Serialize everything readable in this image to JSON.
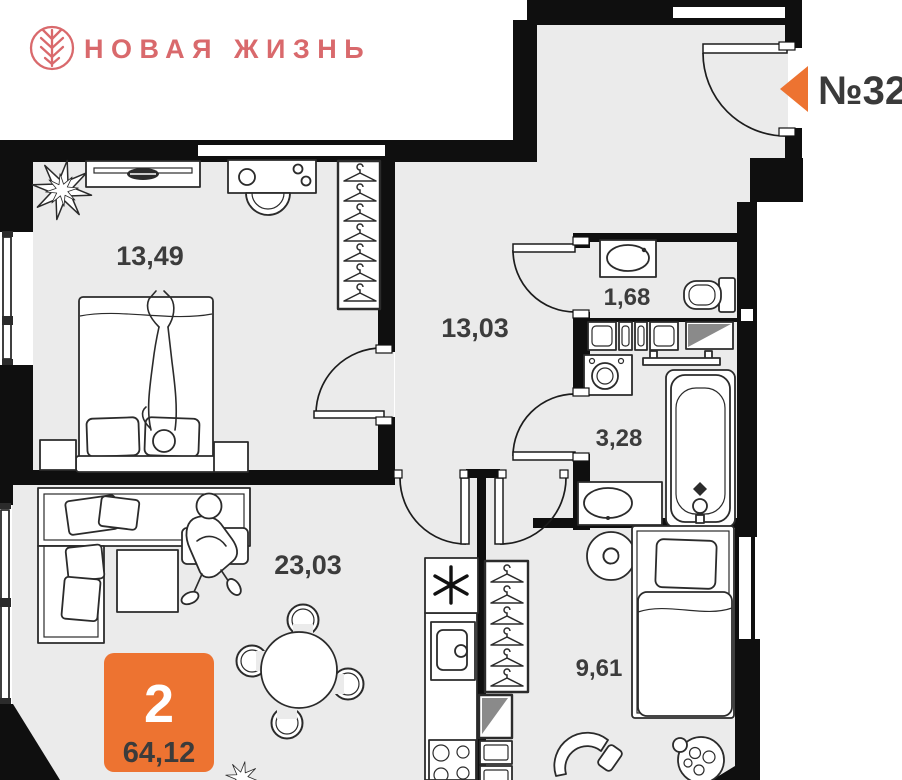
{
  "brand": {
    "name": "НОВАЯ ЖИЗНЬ",
    "color": "#d9696c"
  },
  "apartment": {
    "number": "№32",
    "rooms_count": "2",
    "total_area": "64,12"
  },
  "rooms": {
    "bedroom1": {
      "area": "13,49"
    },
    "hallway": {
      "area": "13,03"
    },
    "wc": {
      "area": "1,68"
    },
    "bathroom": {
      "area": "3,28"
    },
    "living": {
      "area": "23,03"
    },
    "bedroom2": {
      "area": "9,61"
    }
  },
  "colors": {
    "accent_orange": "#ed7331",
    "brand_pink": "#d9696c",
    "wall_black": "#0f0f0f",
    "floor_gray": "#ebebeb",
    "label_gray": "#3c3c3c"
  }
}
